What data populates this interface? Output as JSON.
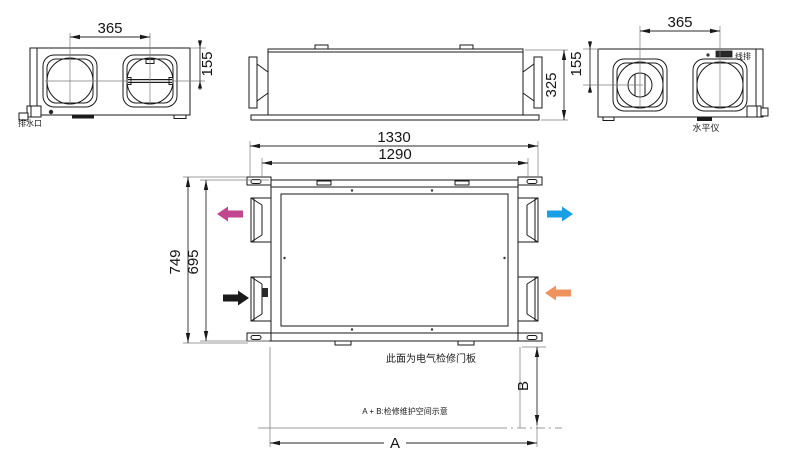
{
  "drawing": {
    "left_view": {
      "dim_port_spacing": "365",
      "dim_port_offset": "155",
      "drain_label": "排水口"
    },
    "front_view": {
      "dim_height": "325"
    },
    "right_view": {
      "dim_port_spacing": "365",
      "dim_port_offset": "155",
      "terminal_label": "线排",
      "level_label": "水平仪"
    },
    "plan_view": {
      "dim_overall_length": "1330",
      "dim_body_length": "1290",
      "dim_overall_depth": "749",
      "dim_body_depth": "695",
      "panel_note": "此面为电气检修门板"
    },
    "service_space": {
      "note": "A + B:检修维护空间示意",
      "dim_a_label": "A",
      "dim_b_label": "B"
    },
    "colors": {
      "exhaust_arrow": "#c2458f",
      "intake_arrow": "#1a1a1a",
      "supply_arrow": "#19a0e4",
      "return_arrow": "#f0925e"
    }
  }
}
